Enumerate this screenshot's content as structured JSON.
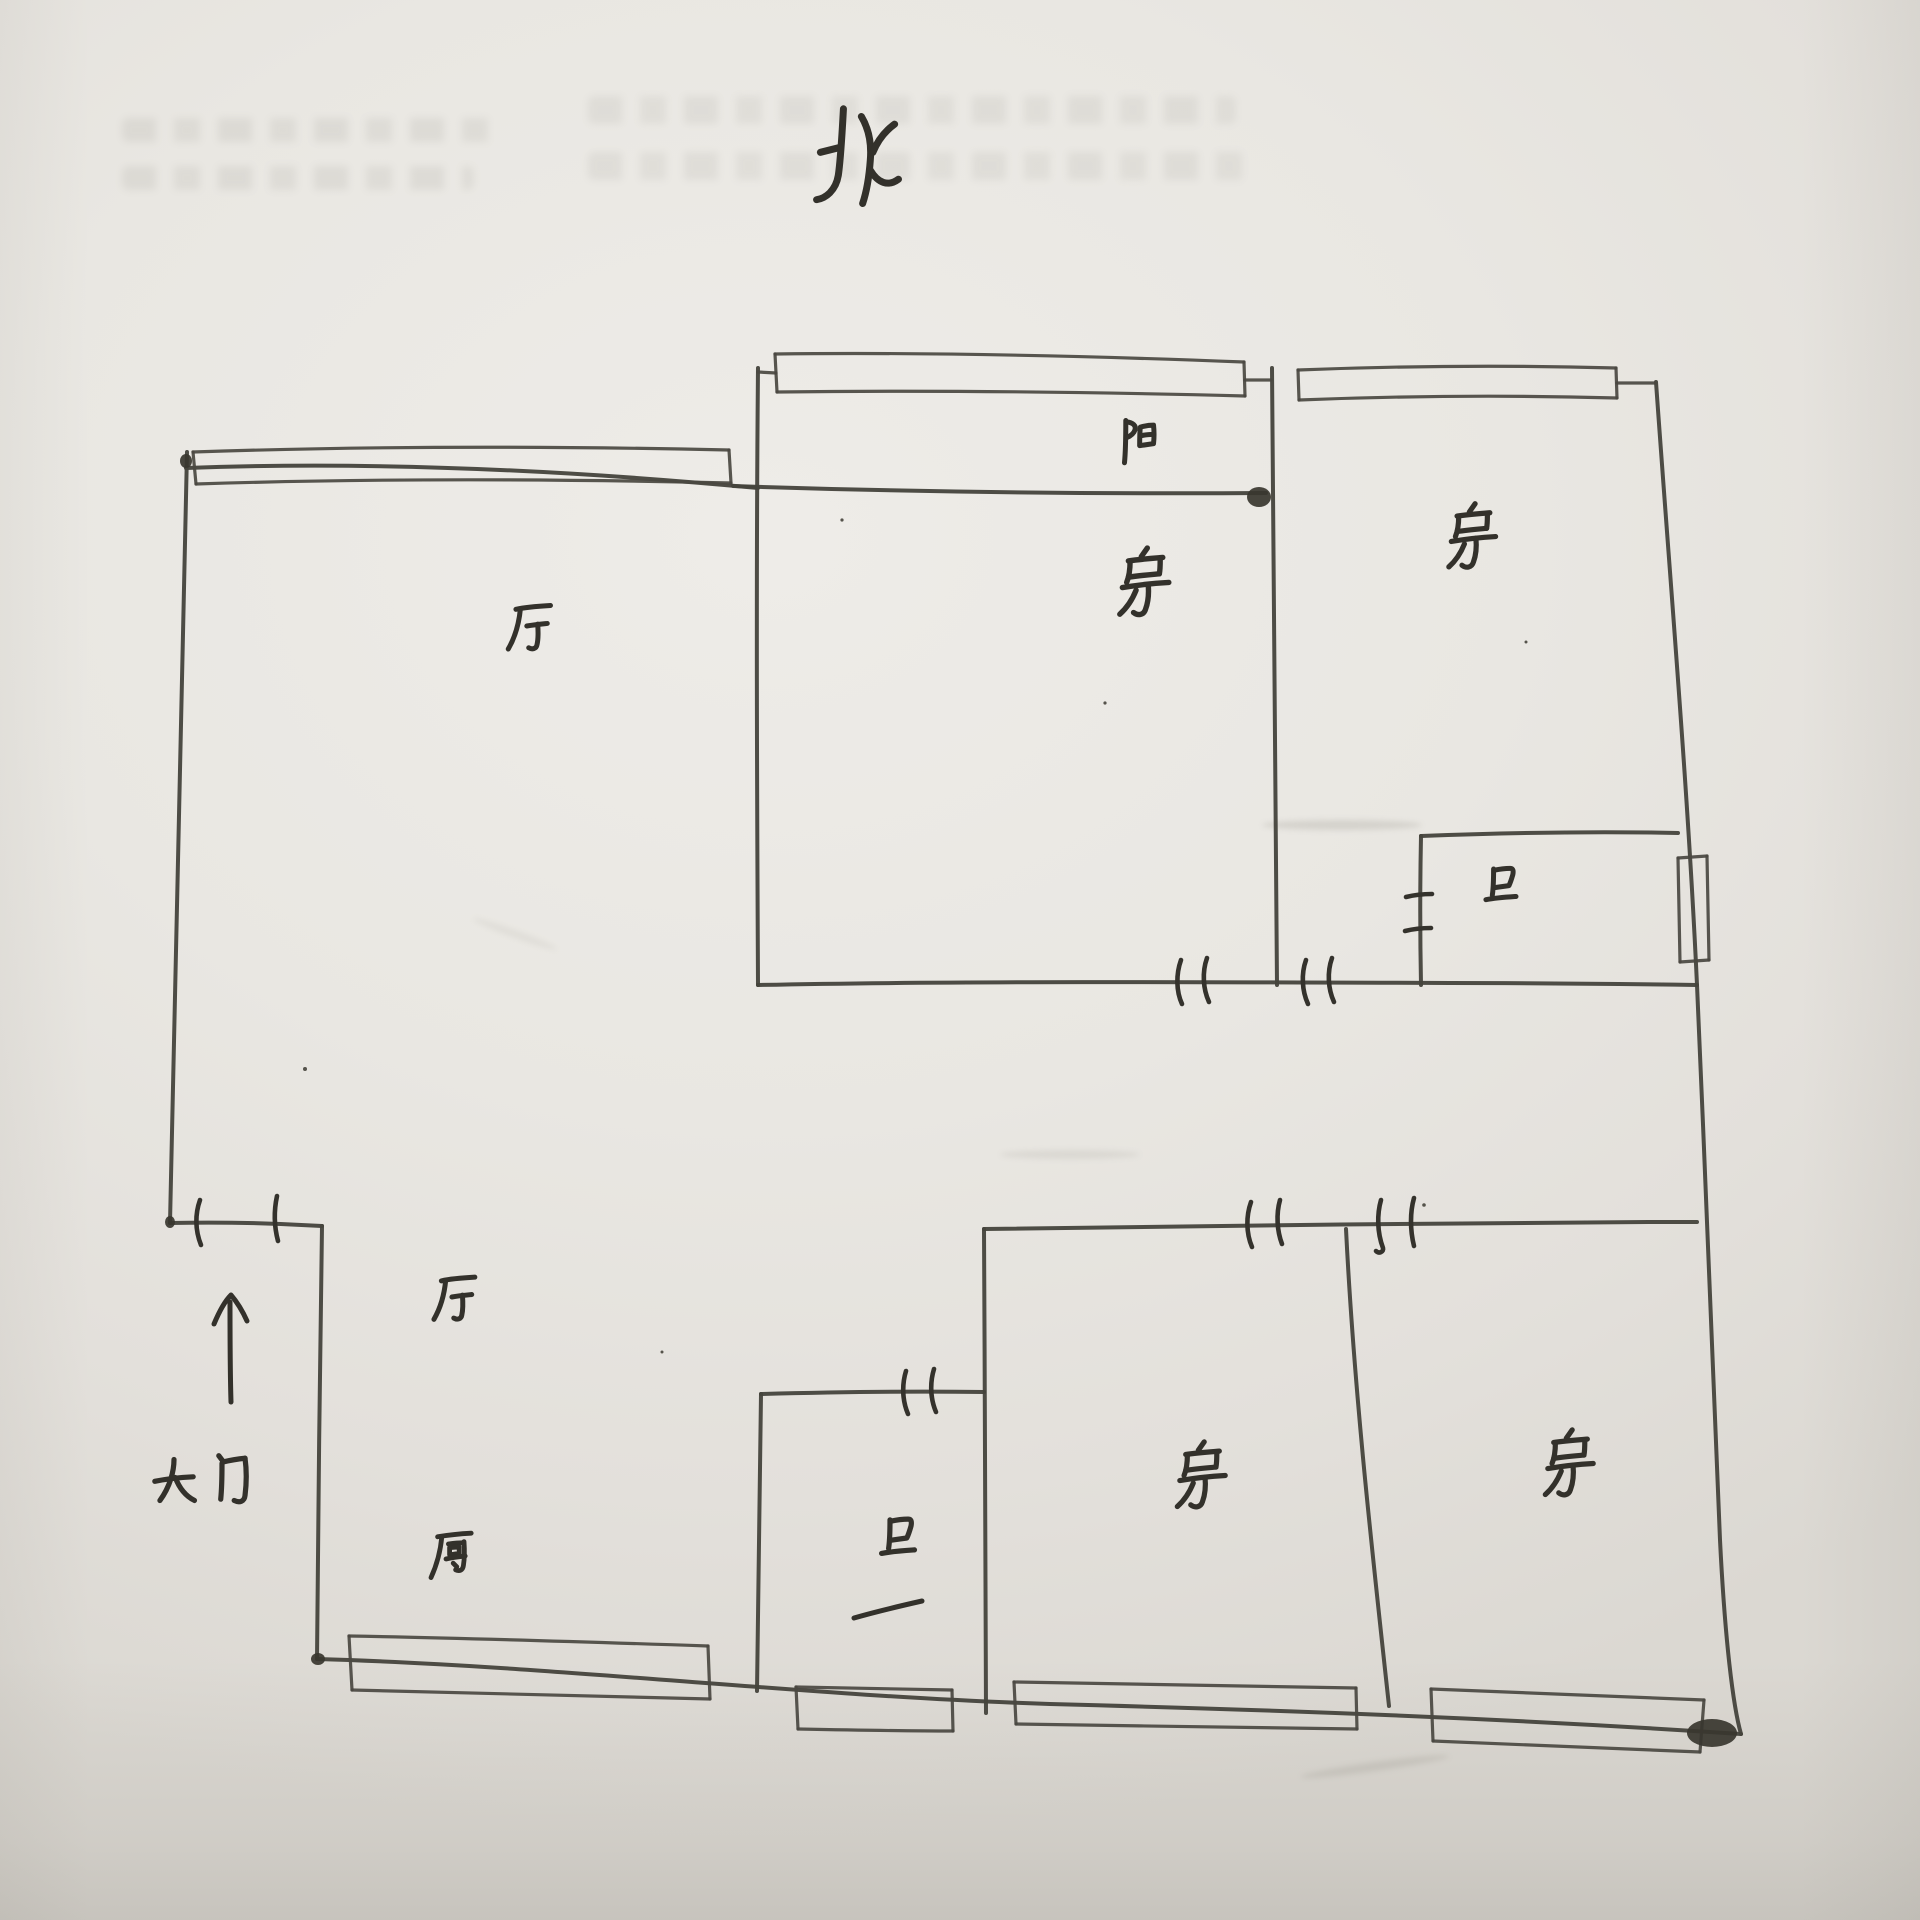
{
  "document": {
    "kind": "hand-drawn apartment floor plan on paper"
  },
  "compass": {
    "label": "北"
  },
  "rooms": {
    "hall_upper": {
      "label": "厅"
    },
    "balcony_strip": {
      "label": "阳"
    },
    "bedroom_middle": {
      "label": "房"
    },
    "bedroom_right": {
      "label": "房"
    },
    "bathroom_upper": {
      "label": "卫"
    },
    "hall_lower": {
      "label": "厅"
    },
    "kitchen": {
      "label": "厨"
    },
    "bathroom_lower": {
      "label": "卫"
    },
    "bedroom_bottom_middle": {
      "label": "房"
    },
    "bedroom_bottom_right": {
      "label": "房"
    }
  },
  "entrance": {
    "label": "大门"
  },
  "colors": {
    "paper": "#e8e6e1",
    "ink": "#3b3933"
  }
}
